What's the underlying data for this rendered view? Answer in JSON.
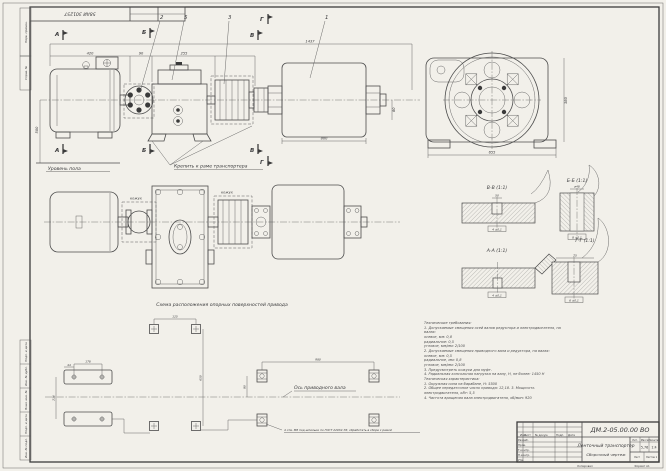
{
  "stamp": {
    "code": "58АИ 301257"
  },
  "margin": {
    "top": [
      "Перв. примен.",
      "Справ. №"
    ],
    "bottom": [
      "Подп. и дата",
      "Инв. № дубл.",
      "Взам. инв. №",
      "Подп. и дата",
      "Инв. № подл."
    ]
  },
  "front": {
    "marks": {
      "a": "А",
      "b": "Б",
      "v": "В",
      "g": "Г"
    },
    "balloons": {
      "n1": "1",
      "n2": "2",
      "n3": "3",
      "n5": "5"
    },
    "dims": {
      "overall": "1437",
      "motor": "420",
      "coupling": "90",
      "gearbox": "255",
      "drum": "800",
      "axis_h": "500",
      "shaft_h": "80"
    },
    "floor": "Уровень пола",
    "mount": "Крепить к раме транспортера"
  },
  "plan": {
    "cover1": "кожух",
    "cover2": "кожух"
  },
  "endview": {
    "dims": {
      "width": "655",
      "height": "380"
    }
  },
  "sections": {
    "vv": {
      "label": "В-В (1:1)",
      "top": "50",
      "tol": "4 ±0,1"
    },
    "bb": {
      "label": "Б-Б (1:1)",
      "top": "ø48",
      "tol": "8 ±0,1"
    },
    "aa": {
      "label": "А-А (1:1)",
      "tol": "4 ±0,1"
    },
    "gg": {
      "label": "Г-Г (1:1)",
      "top": "75",
      "tol": "6 ±0,1"
    }
  },
  "scheme": {
    "title": "Схема расположения опорных поверхностей привода",
    "axis": "Ось приводного вала",
    "note": "4 отв. М8 под шпильки по ГОСТ 22032-76; обработать в сборе с рамой",
    "dims": {
      "d44": "44",
      "d178": "178",
      "d236": "236",
      "d125": "125",
      "d650": "650",
      "d980": "980",
      "d80": "80"
    }
  },
  "tech": {
    "lines": [
      "Технические требования:",
      "1. Допускаемые смещения осей валов редуктора и электродвигателя, на",
      "валах:",
      "осевое, мм:            0,8",
      "радиальное:            0,5",
      "угловое, мм/мм:        2/100",
      "2. Допускаемые смещения приводного вала и редуктора, на валах:",
      "осевое, мм:            0,5",
      "радиальное, мм:        0,8",
      "угловое, мм/мм:        2/100",
      "3. Предусмотреть кожухи для муфт.",
      "4. Радиальная консольная нагрузка на валу, Н, не более: 1450 Н",
      "Техническая характеристика:",
      "1. Окружная сила на барабане, Н: 5500",
      "2. Общее передаточное число привода: 12,18. 3. Мощность",
      "электродвигателя, кВт: 5,5",
      "4. Частота вращения вала электродвигателя, об/мин: 920"
    ]
  },
  "titleblock": {
    "doc_number": "ДМ.2-05.00.00 ВО",
    "title_line1": "Ленточный транспортер",
    "title_line2": "Сборочный чертеж",
    "cols": {
      "izm": "Изм.",
      "list": "Лист",
      "doc": "№ докум.",
      "podp": "Подп.",
      "data": "Дата"
    },
    "rows": {
      "razrab": "Разраб.",
      "prov": "Пров.",
      "tkontr": "Т.контр.",
      "nkontr": "Н.контр.",
      "utv": "Утв."
    },
    "right": {
      "lit": "Лит.",
      "massa": "Масса",
      "masshtab": "Масштаб",
      "massa_val": "5,76",
      "scale_val": "1:4",
      "list": "Лист",
      "listov": "Листов 1"
    },
    "footer": {
      "copied": "Копировал",
      "format": "Формат А1"
    }
  }
}
